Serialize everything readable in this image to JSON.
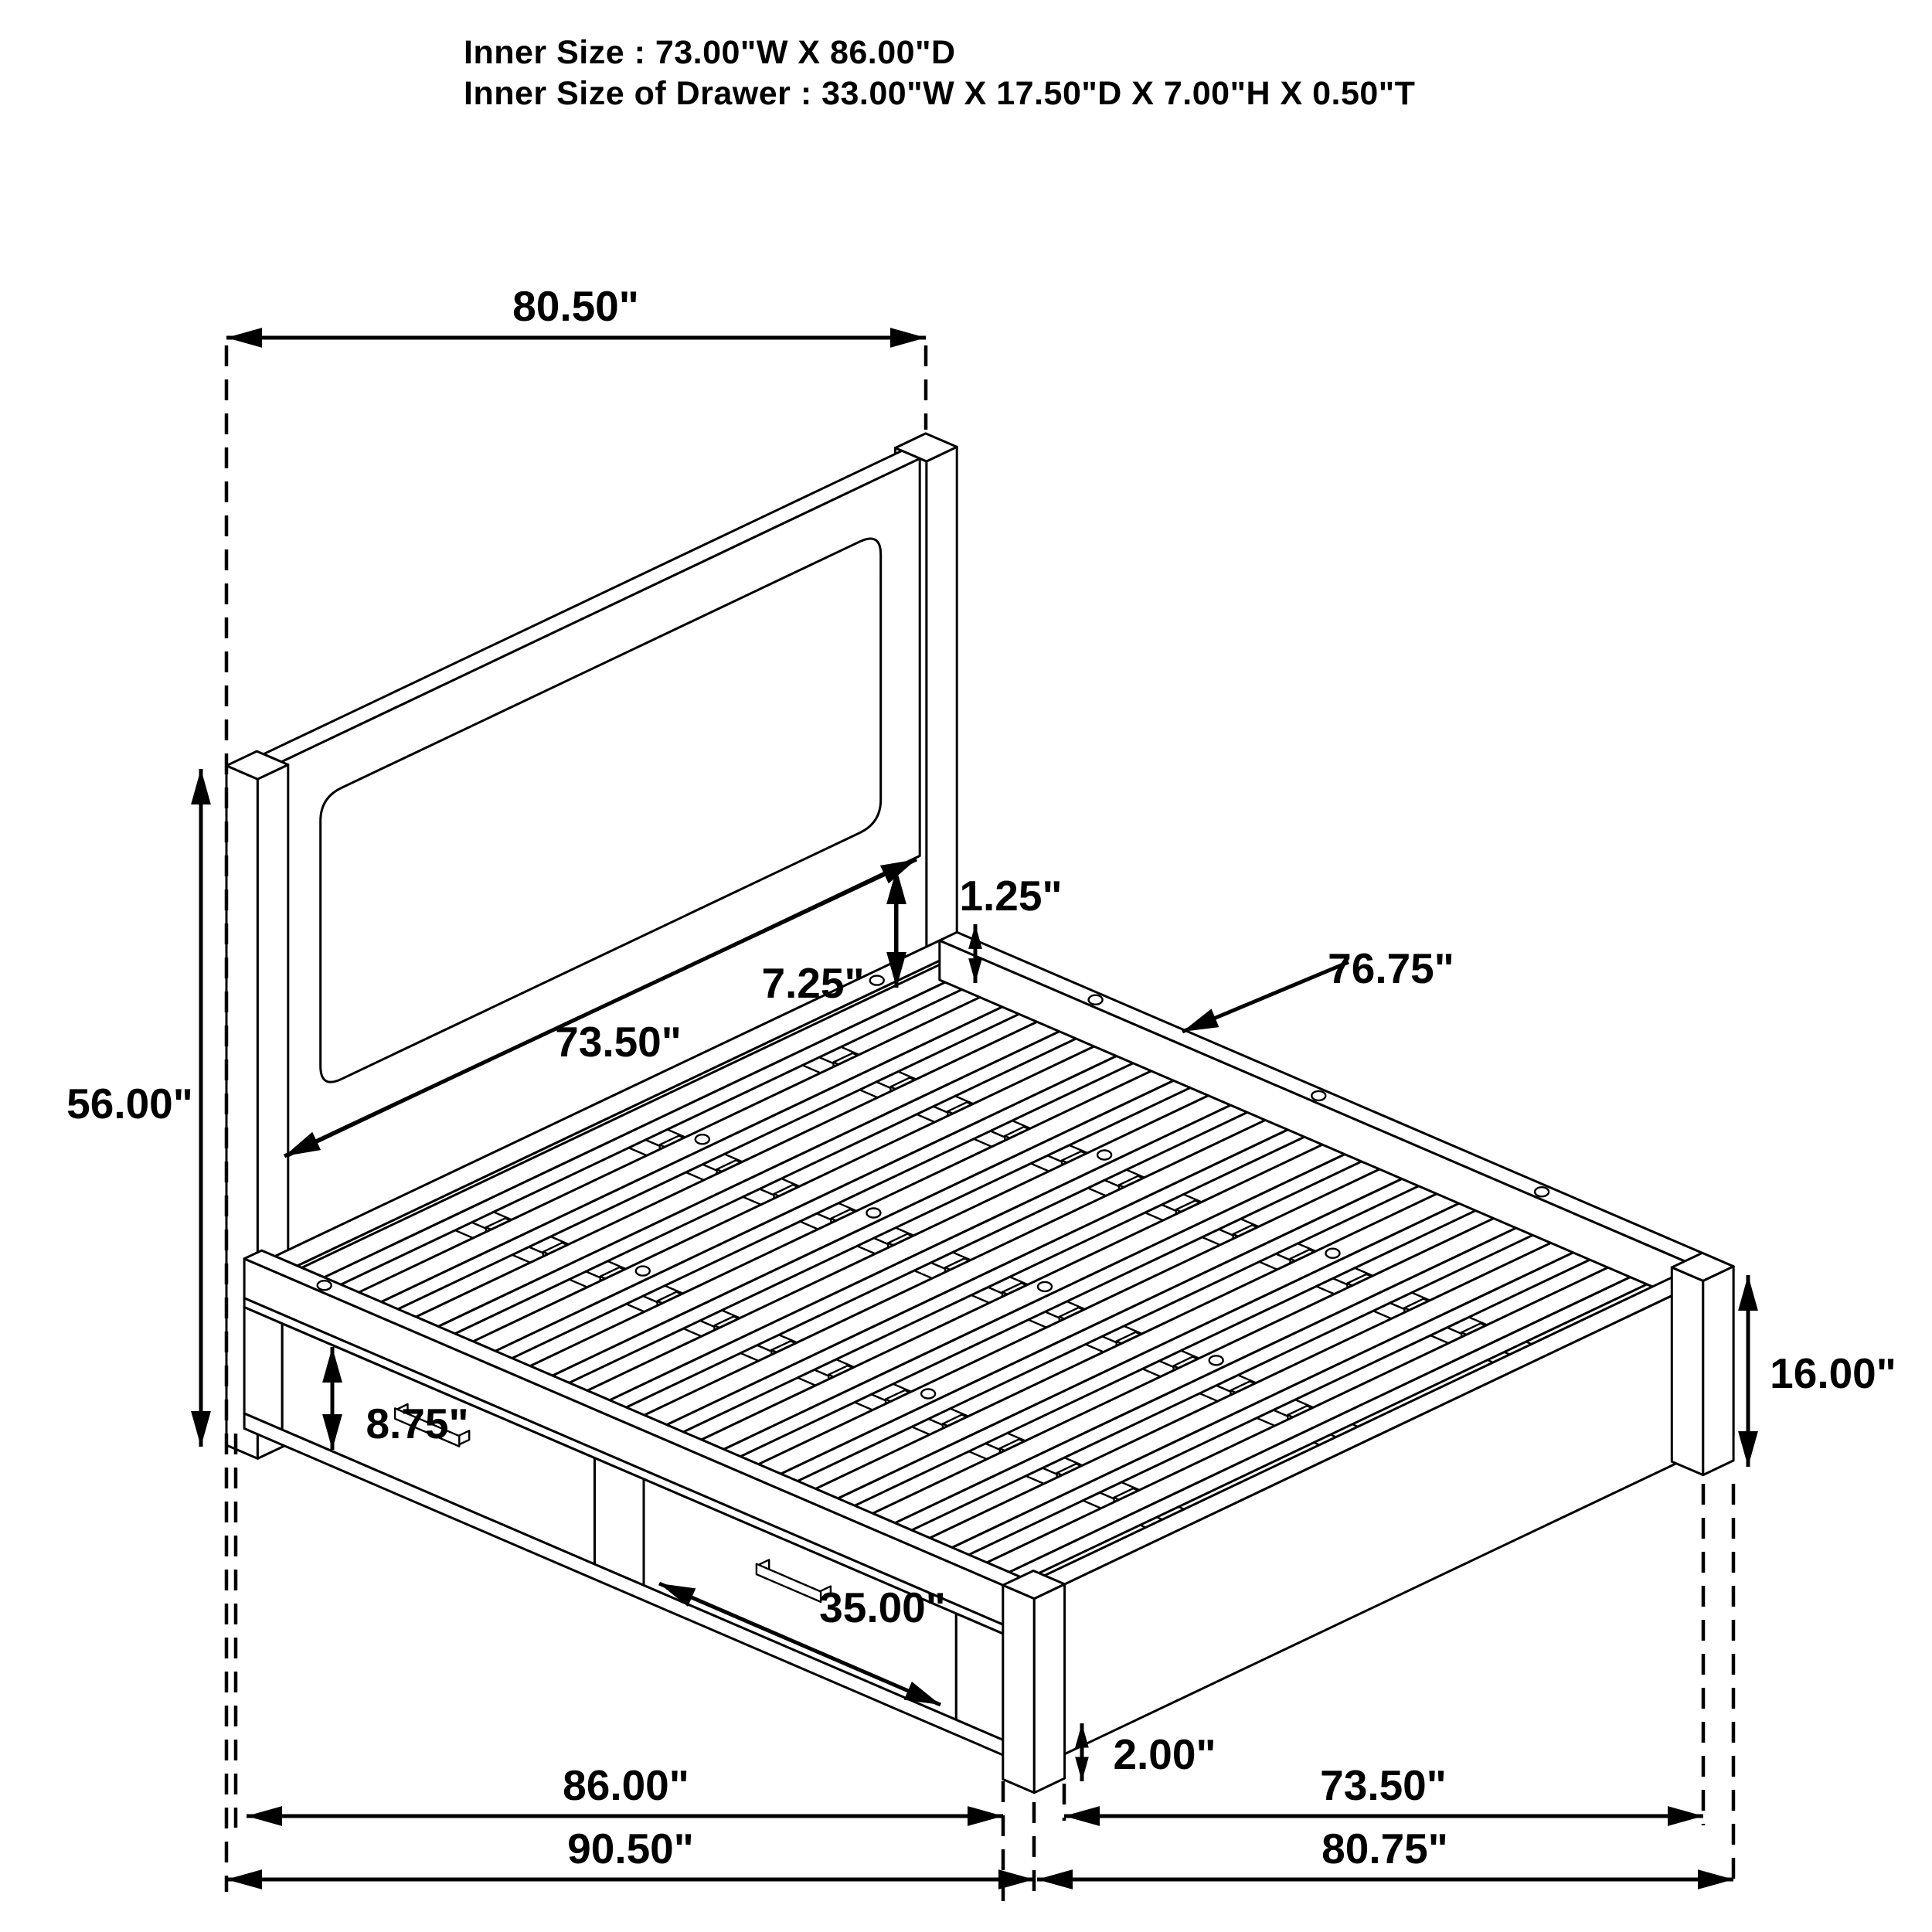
{
  "title": "Storage bed technical dimension diagram",
  "header": {
    "line1": "Inner Size : 73.00\"W X 86.00\"D",
    "line2": "Inner Size of Drawer : 33.00\"W X 17.50\"D X 7.00\"H X 0.50\"T"
  },
  "dimensions": {
    "overall_width_top": "80.50\"",
    "headboard_height": "56.00\"",
    "headboard_panel_gap": "7.25\"",
    "slat_thickness": "1.25\"",
    "slat_length": "76.75\"",
    "headboard_inner_width": "73.50\"",
    "drawer_front_height": "8.75\"",
    "drawer_front_width": "35.00\"",
    "side_rail_height": "16.00\"",
    "floor_clearance": "2.00\"",
    "platform_length": "86.00\"",
    "overall_length": "90.50\"",
    "footboard_inner_width": "73.50\"",
    "footboard_outer_width": "80.75\""
  },
  "colors": {
    "line": "#000000",
    "background": "#ffffff"
  }
}
